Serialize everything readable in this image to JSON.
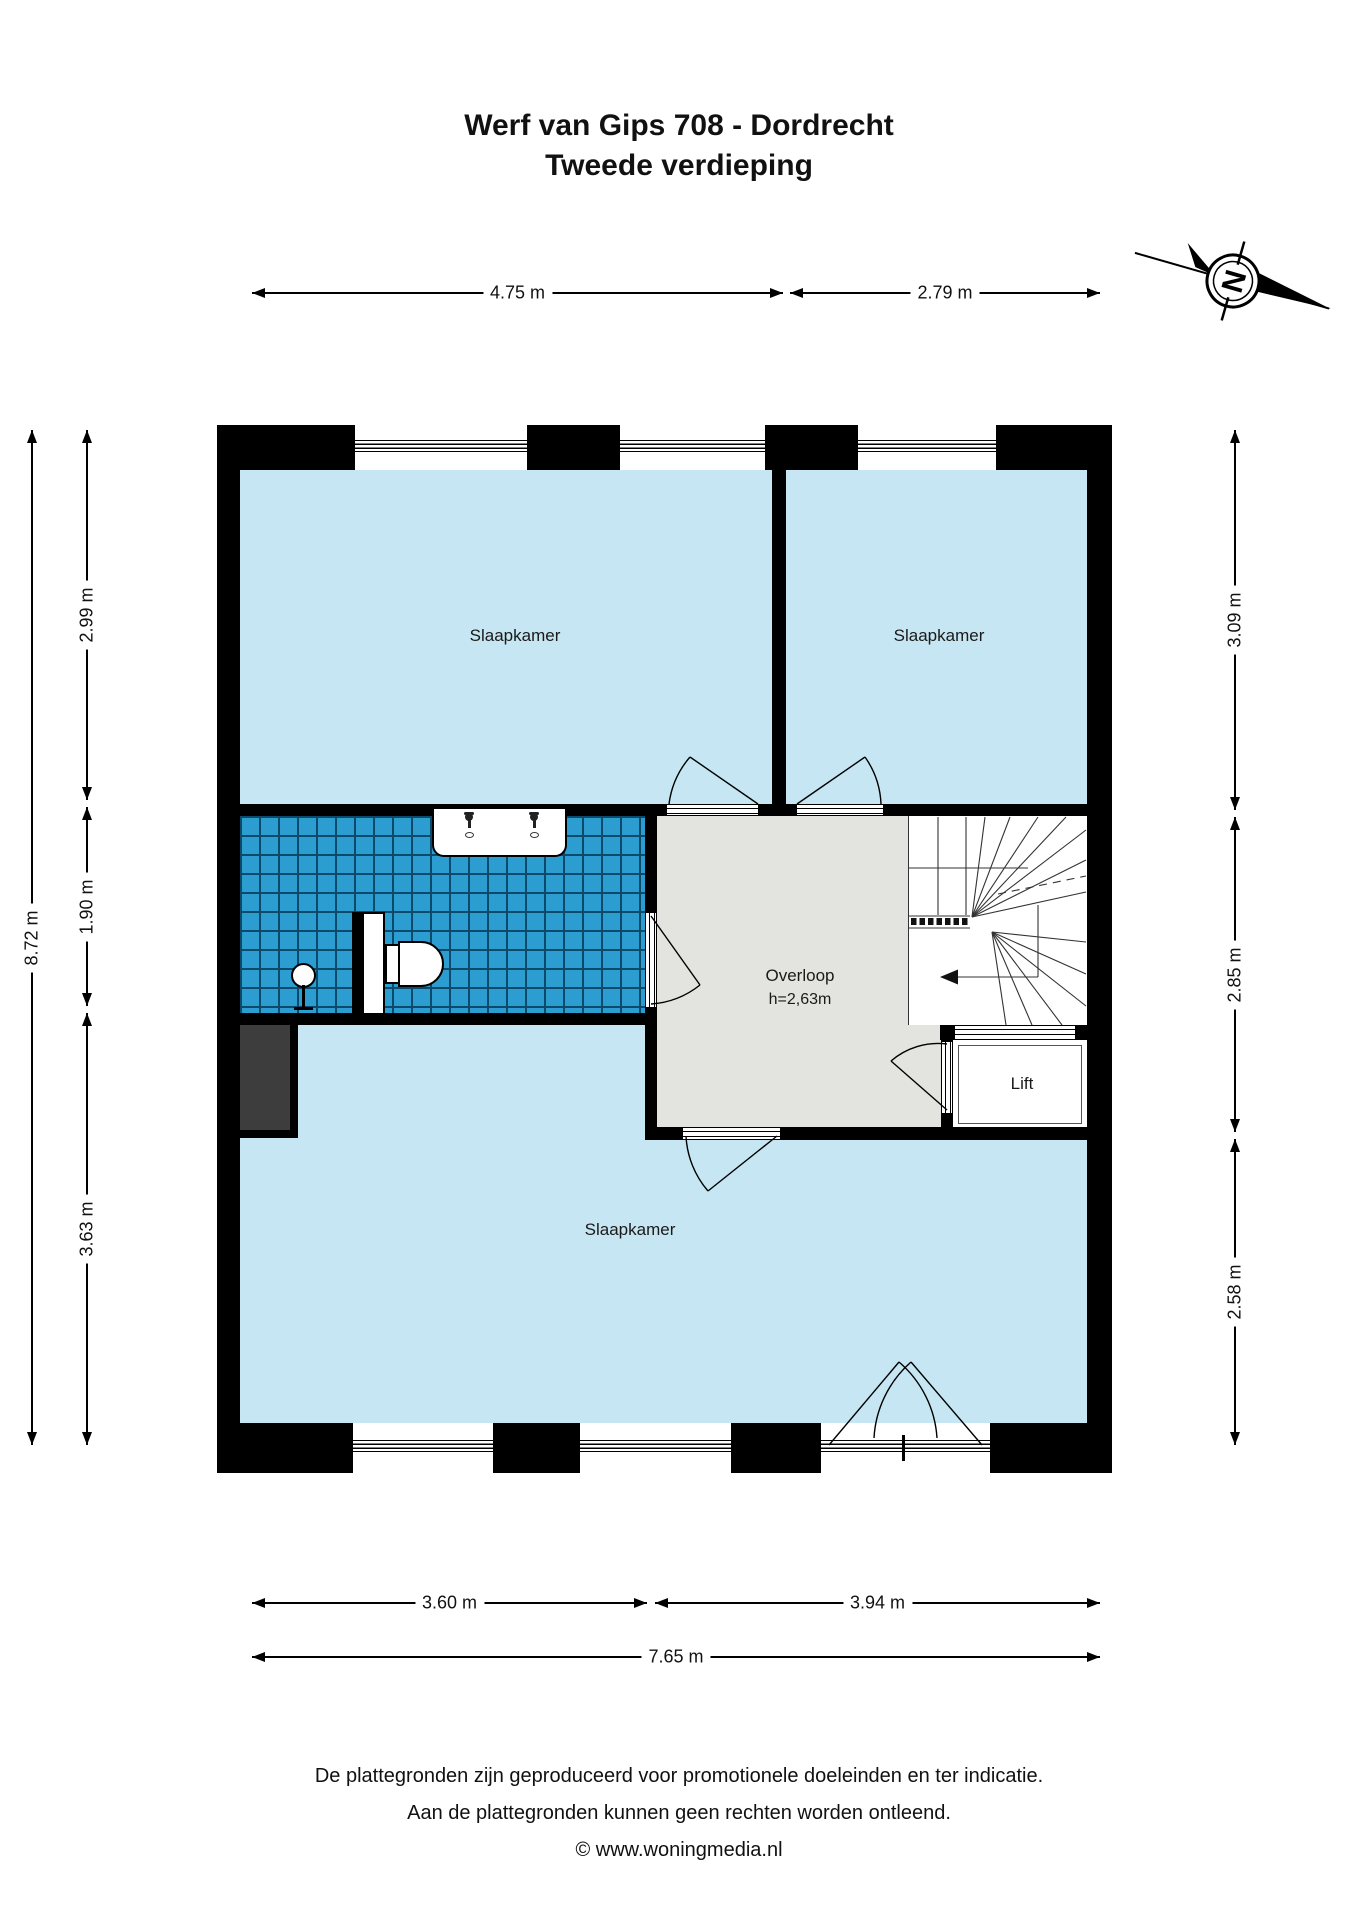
{
  "title": {
    "line1": "Werf van Gips 708 - Dordrecht",
    "line2": "Tweede verdieping"
  },
  "compass": {
    "letter": "N"
  },
  "rooms": {
    "bedroom_top_left": "Slaapkamer",
    "bedroom_top_right": "Slaapkamer",
    "bedroom_bottom": "Slaapkamer",
    "landing": "Overloop",
    "landing_height": "h=2,63m",
    "lift": "Lift"
  },
  "dimensions": {
    "top": [
      "4.75 m",
      "2.79 m"
    ],
    "bottom": [
      "3.60 m",
      "3.94 m"
    ],
    "bottom_total": "7.65 m",
    "left": [
      "2.99 m",
      "1.90 m",
      "3.63 m"
    ],
    "left_total": "8.72 m",
    "right": [
      "3.09 m",
      "2.85 m",
      "2.58 m"
    ]
  },
  "footer": {
    "line1": "De plattegronden zijn geproduceerd voor promotionele doeleinden en ter indicatie.",
    "line2": "Aan de plattegronden kunnen geen rechten worden ontleend.",
    "line3": "© www.woningmedia.nl"
  },
  "colors": {
    "room_fill": "#c5e6f2",
    "tile_fill": "#2b9dd1",
    "tile_grid": "#0c4a6b",
    "landing_fill": "#e3e3df",
    "shaft_fill": "#3d3d3d",
    "wall": "#000000"
  }
}
